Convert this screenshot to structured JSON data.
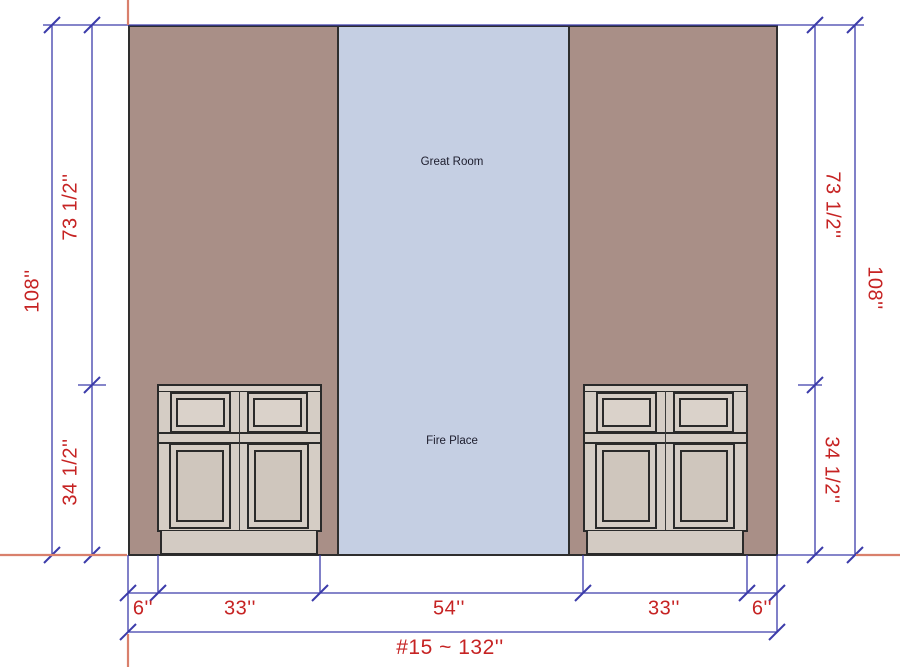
{
  "drawing_labels": {
    "great_room": "Great Room",
    "fire_place": "Fire Place"
  },
  "dimensions": {
    "left": {
      "overall": "108''",
      "upper": "73 1/2''",
      "lower": "34 1/2''"
    },
    "right": {
      "overall": "108''",
      "upper": "73 1/2''",
      "lower": "34 1/2''"
    },
    "bottom": [
      "6''",
      "33''",
      "54''",
      "33''",
      "6''"
    ],
    "overall": "#15 ~ 132''"
  },
  "colors": {
    "wall": "#a98f87",
    "fireplace_opening": "#c5cfe3",
    "cabinet": "#d5cdc5",
    "dimension_line": "#3c3caa",
    "dimension_text": "#c62323",
    "guide_line": "#d9806c"
  }
}
